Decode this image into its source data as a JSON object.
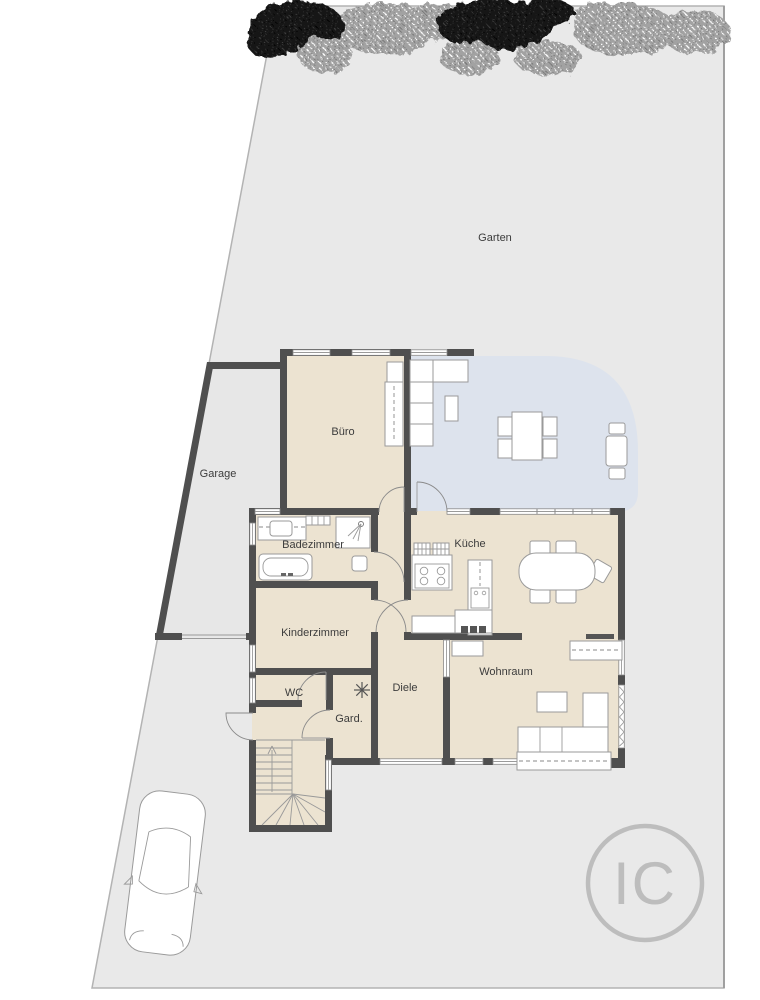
{
  "plan": {
    "rooms": {
      "garten": {
        "label": "Garten"
      },
      "garage": {
        "label": "Garage"
      },
      "buero": {
        "label": "Büro"
      },
      "badezimmer": {
        "label": "Badezimmer"
      },
      "kueche": {
        "label": "Küche"
      },
      "kinderzimmer": {
        "label": "Kinderzimmer"
      },
      "wc": {
        "label": "WC"
      },
      "garderobe": {
        "label": "Gard."
      },
      "diele": {
        "label": "Diele"
      },
      "wohnraum": {
        "label": "Wohnraum"
      }
    },
    "logo": {
      "text": "IC"
    },
    "colors": {
      "property_fill": "#e9e9e9",
      "floor_fill": "#ece3d1",
      "terrace_fill": "#dde3ed",
      "wall_color": "#4f4f4f",
      "tree_dark": "#161616",
      "tree_light": "#a2a2a2",
      "logo_color": "#bdbdbd"
    }
  }
}
